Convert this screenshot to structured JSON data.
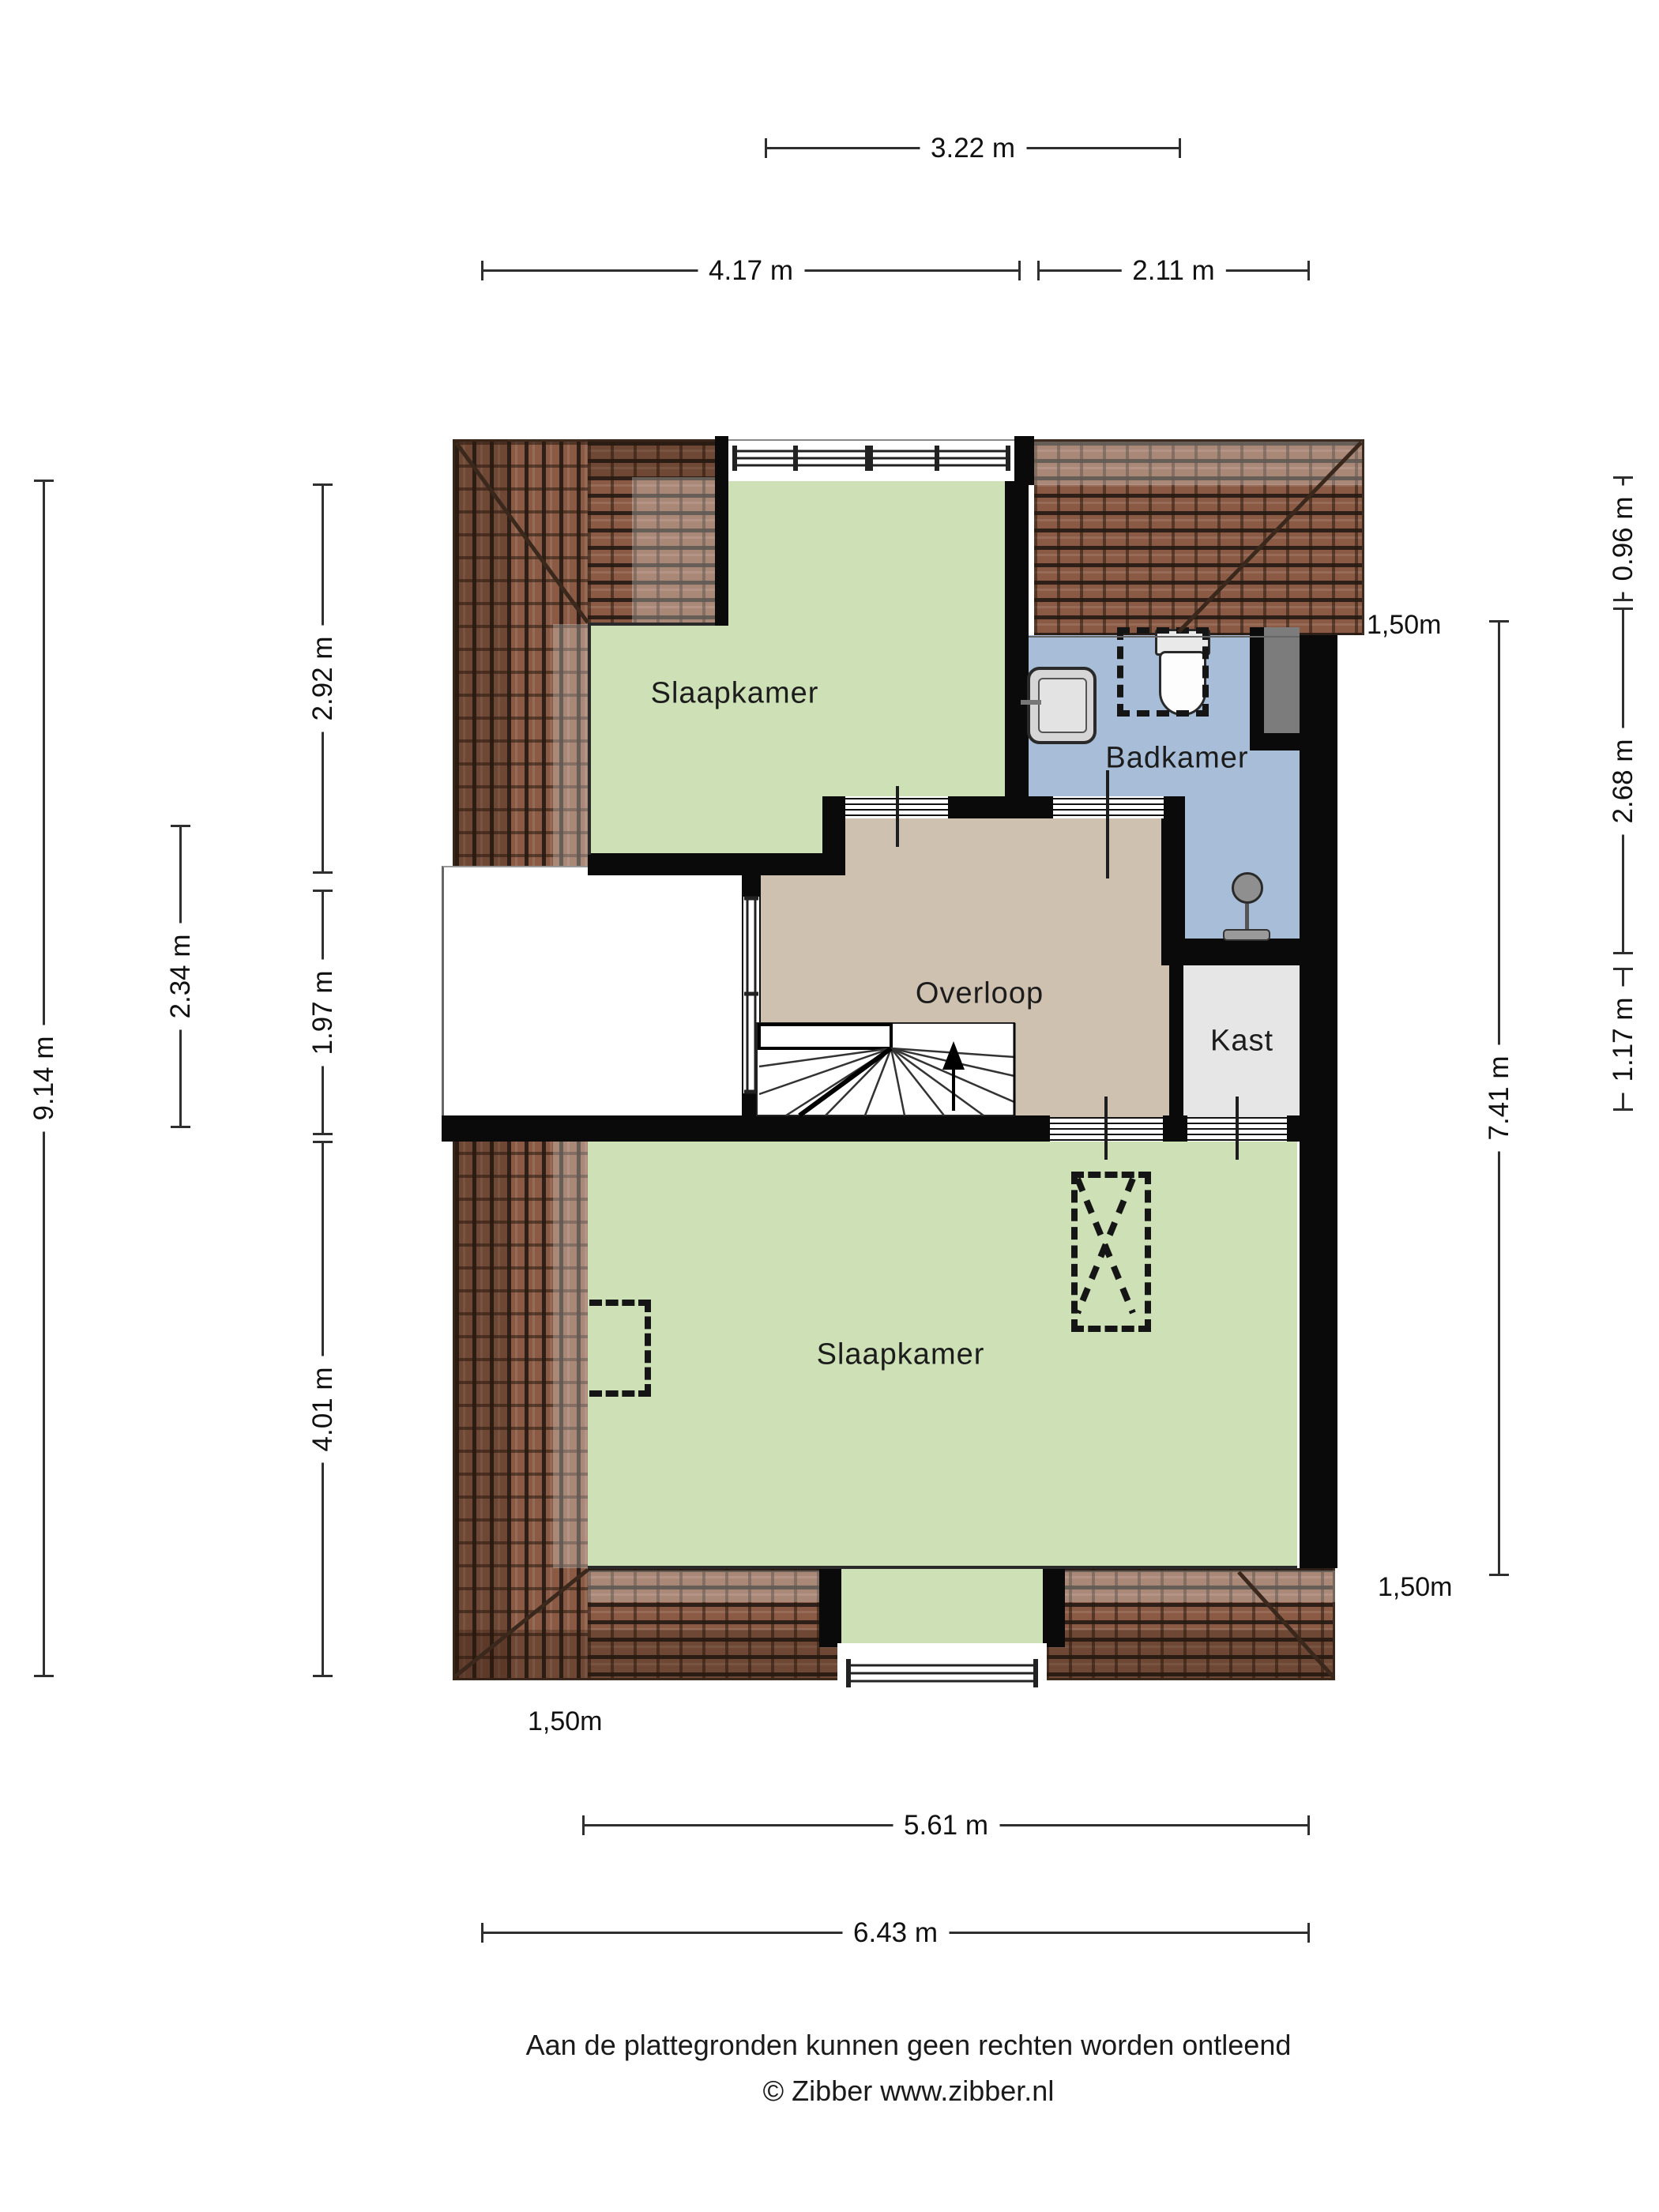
{
  "title": "Floor plan - attic storey (Zibber plattegrond)",
  "rooms": {
    "bedroom_top": {
      "label": "Slaapkamer"
    },
    "bathroom": {
      "label": "Badkamer"
    },
    "landing": {
      "label": "Overloop"
    },
    "closet": {
      "label": "Kast"
    },
    "bedroom_bottom": {
      "label": "Slaapkamer"
    }
  },
  "fixtures": {
    "toilet": "toilet-icon",
    "sink": "washbasin-icon",
    "shower": "shower-icon",
    "stairs": "winder-staircase-icon",
    "skylight_cross": "skylight-dashed-icon",
    "skylight_small": "skylight-dashed-icon",
    "shower_niche": "dashed-outline-icon",
    "duct": "shaft-block"
  },
  "dimensions": {
    "top": [
      {
        "label": "3.22 m"
      },
      {
        "label": "4.17 m"
      },
      {
        "label": "2.11 m"
      }
    ],
    "left": [
      {
        "label": "9.14 m"
      },
      {
        "label": "2.34 m"
      },
      {
        "label": "2.92 m"
      },
      {
        "label": "1.97 m"
      },
      {
        "label": "4.01 m"
      }
    ],
    "right": [
      {
        "label": "0.96 m"
      },
      {
        "label": "2.68 m"
      },
      {
        "label": "1.17 m"
      },
      {
        "label": "7.41 m"
      }
    ],
    "bottom": [
      {
        "label": "5.61 m"
      },
      {
        "label": "6.43 m"
      }
    ]
  },
  "height_markers": [
    {
      "label": "1,50m"
    },
    {
      "label": "1,50m"
    },
    {
      "label": "1,50m"
    }
  ],
  "footer": {
    "disclaimer": "Aan de plattegronden kunnen geen rechten worden ontleend",
    "credit": "© Zibber www.zibber.nl"
  },
  "colors": {
    "room_green": "#cde0b6",
    "room_tan": "#cfc1b0",
    "room_blue": "#a8bed8",
    "room_gray": "#e6e6e6",
    "roof_tile": "#8a5a45",
    "wall": "#0a0a0a"
  }
}
